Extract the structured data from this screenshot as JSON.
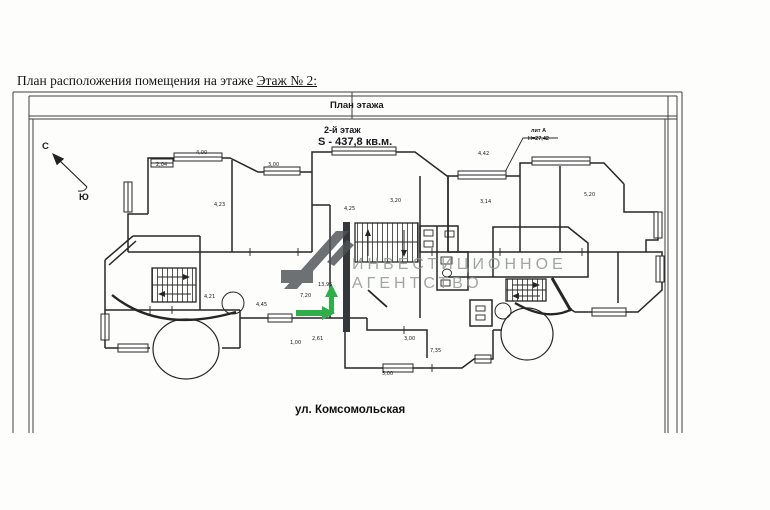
{
  "title": {
    "prefix": "План расположения помещения на этаже ",
    "floor_ref": "Этаж № 2:"
  },
  "plan_header": {
    "band_label": "План этажа",
    "floor_label": "2-й этаж",
    "area_label": "S - 437,8 кв.м."
  },
  "building": {
    "lit_label": "лит А",
    "height_label": "Н=27,42"
  },
  "compass": {
    "north": "С",
    "south": "Ю"
  },
  "street_label": "ул. Комсомольская",
  "watermark": {
    "line1": "ИНВЕСТИЦИОННОЕ",
    "line2": "АГЕНТСТВО",
    "text_color": "#929597",
    "logo_color": "#4e5357"
  },
  "highlight": {
    "arrow_color": "#2fae4a",
    "arrows": [
      "up",
      "right"
    ]
  },
  "plan": {
    "dimensions": [
      {
        "t": "4,00",
        "x": 196,
        "y": 151
      },
      {
        "t": "2,04",
        "x": 156,
        "y": 163
      },
      {
        "t": "3,00",
        "x": 268,
        "y": 163
      },
      {
        "t": "4,42",
        "x": 478,
        "y": 152
      },
      {
        "t": "3,20",
        "x": 390,
        "y": 199
      },
      {
        "t": "5,20",
        "x": 584,
        "y": 193
      },
      {
        "t": "3,14",
        "x": 480,
        "y": 200
      },
      {
        "t": "4,23",
        "x": 214,
        "y": 203
      },
      {
        "t": "4,25",
        "x": 344,
        "y": 207
      },
      {
        "t": "4,45",
        "x": 256,
        "y": 303
      },
      {
        "t": "4,21",
        "x": 204,
        "y": 295
      },
      {
        "t": "7,20",
        "x": 300,
        "y": 294
      },
      {
        "t": "13,95",
        "x": 318,
        "y": 283
      },
      {
        "t": "2,61",
        "x": 312,
        "y": 337
      },
      {
        "t": "7,35",
        "x": 430,
        "y": 349
      },
      {
        "t": "5,00",
        "x": 382,
        "y": 372
      },
      {
        "t": "1,00",
        "x": 290,
        "y": 341
      },
      {
        "t": "3,00",
        "x": 404,
        "y": 337
      }
    ]
  },
  "colors": {
    "ink": "#262626",
    "frame": "#3f3f3f"
  }
}
